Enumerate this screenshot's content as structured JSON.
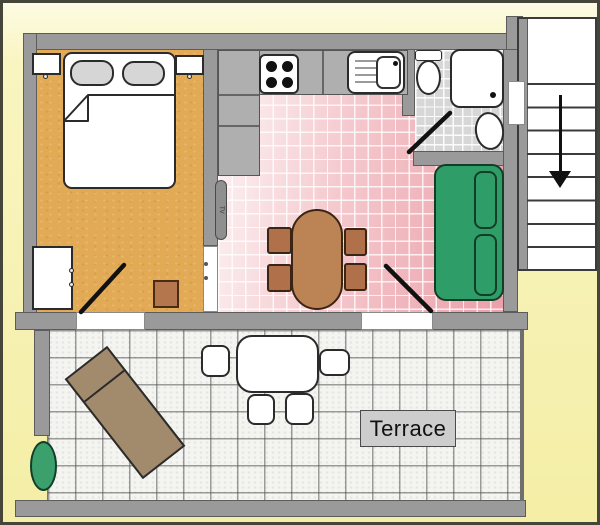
{
  "labels": {
    "terrace": "Terrace",
    "tv": "TV"
  },
  "colors": {
    "background": "#f8f4bb",
    "wall": "#9a9a9a",
    "bedroom_floor": "#e2aa55",
    "kitchen_floor_pink": "#efa9b1",
    "bathroom_floor": "#d7d7d7",
    "terrace_floor": "#f2f2ef",
    "counter_gray": "#afafaf",
    "sofa_green": "#2f9d68",
    "dining_wood": "#bc8355",
    "chair_wood": "#b0714a",
    "lounge_brown": "#a18b6c",
    "plant_green": "#3ba06b",
    "pillow_gray": "#d6d6d6",
    "stool_brown": "#b4764c",
    "door_line": "#111111"
  },
  "rooms": {
    "bedroom": {
      "furniture": [
        "double-bed",
        "pillow",
        "pillow",
        "nightstand",
        "nightstand",
        "wardrobe",
        "stool",
        "door-swing"
      ]
    },
    "kitchen": {
      "furniture": [
        "counter",
        "stove-4-burners",
        "sink-with-drainboard",
        "cabinet-column",
        "tv"
      ]
    },
    "dining": {
      "furniture": [
        "oval-table",
        "chair",
        "chair",
        "chair",
        "chair"
      ]
    },
    "bathroom": {
      "furniture": [
        "toilet",
        "shower",
        "washbasin",
        "door-swing"
      ]
    },
    "living": {
      "furniture": [
        "sofa-two-cushions",
        "door-swing"
      ]
    },
    "terrace": {
      "furniture": [
        "sun-lounger",
        "table",
        "chair",
        "chair",
        "chair",
        "chair",
        "plant"
      ]
    },
    "staircase": {
      "direction": "down",
      "steps_visible": 9
    }
  }
}
